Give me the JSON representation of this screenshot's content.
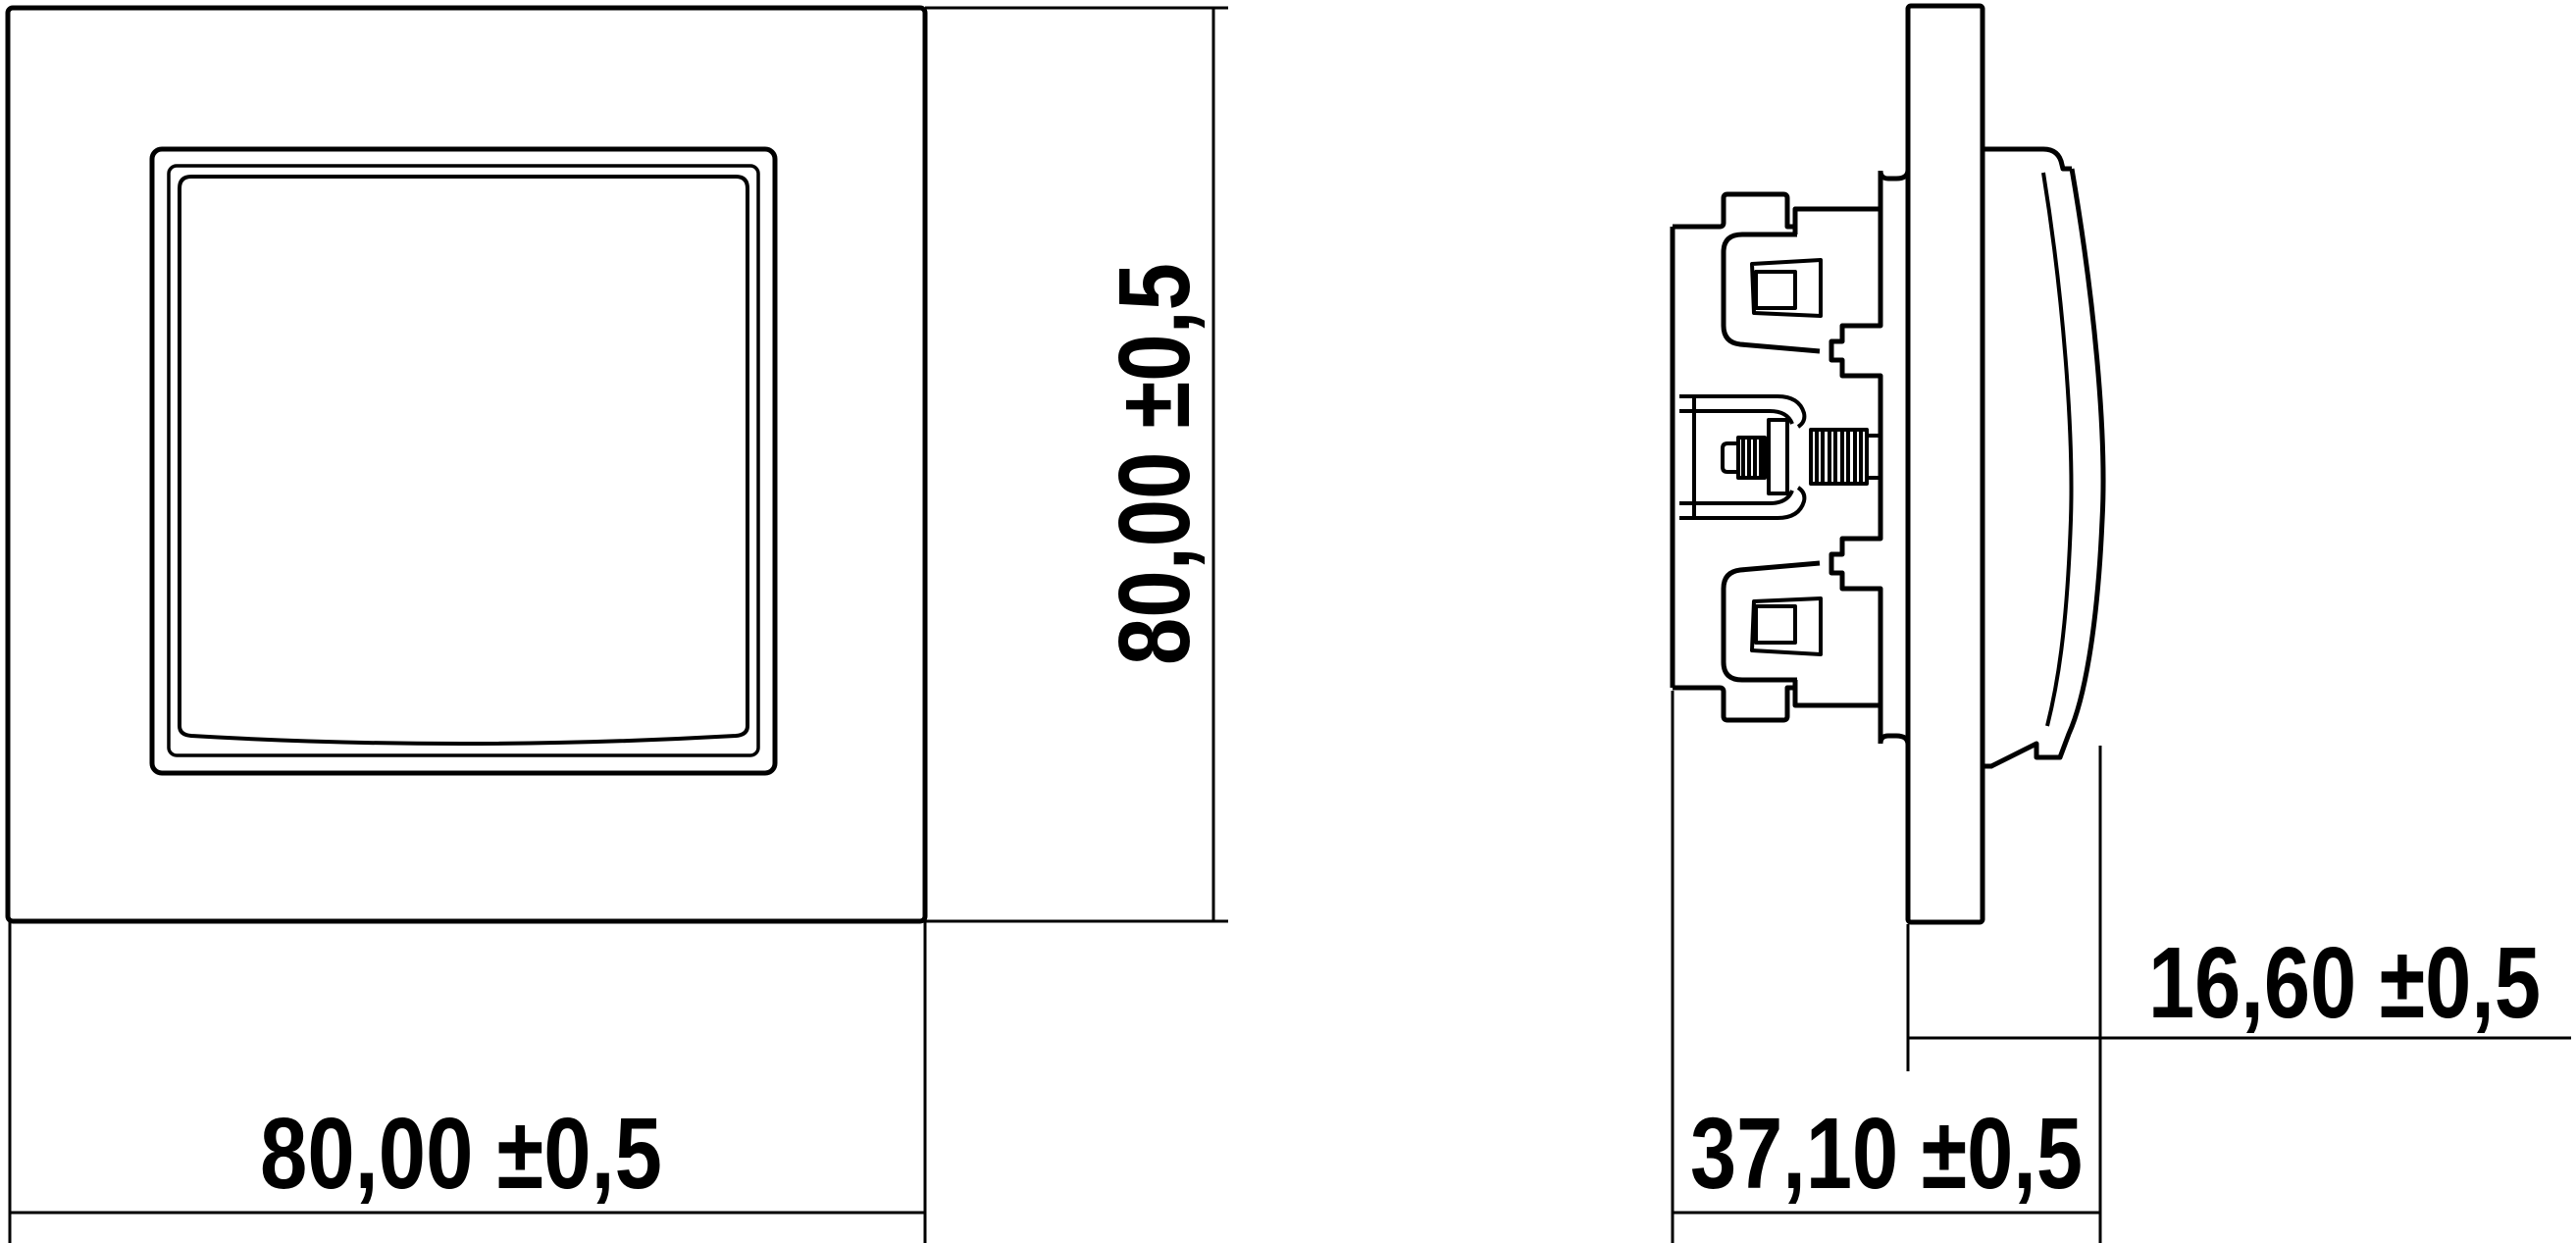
{
  "drawing": {
    "background_color": "#ffffff",
    "line_color": "#000000",
    "dimensions": {
      "front_width_label": "80,00 ±0,5",
      "front_height_label": "80,00 ±0,5",
      "side_total_depth_label": "37,10 ±0,5",
      "side_front_depth_label": "16,60 ±0,5"
    }
  }
}
